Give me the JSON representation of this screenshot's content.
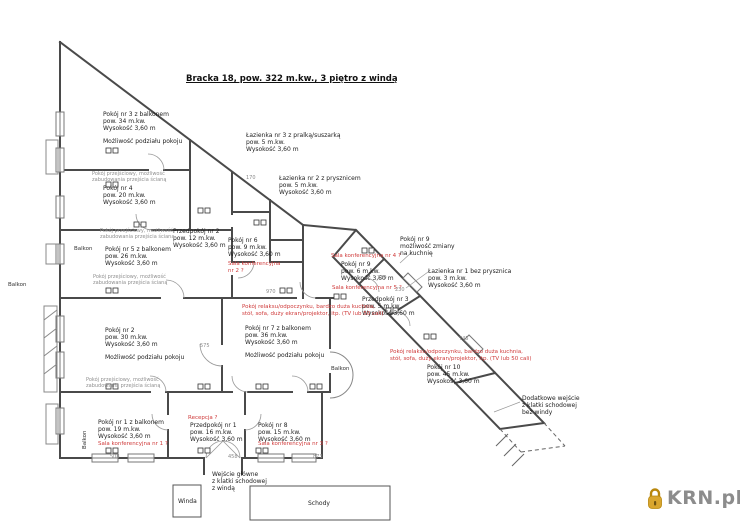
{
  "title": "Bracka 18, pow. 322 m.kw., 3 piętro z windą",
  "watermark": {
    "brand": "KRN.pl"
  },
  "colors": {
    "wall": "#4a4a4a",
    "red": "#cf3a3a",
    "note": "#8f8f8f",
    "logo_gold": "#d9a62e",
    "logo_text": "#8c8c8c"
  },
  "annotations": [
    {
      "name": "label-room-3",
      "kind": "room",
      "x": 103,
      "y": 111,
      "lines": [
        "Pokój nr 3 z balkonem",
        "pow. 34 m.kw.",
        "Wysokość 3,60 m",
        "",
        "Możliwość podziału pokoju"
      ]
    },
    {
      "name": "label-room-4",
      "kind": "room",
      "x": 103,
      "y": 185,
      "lines": [
        "Pokój nr 4",
        "pow. 20 m.kw.",
        "Wysokość 3,60 m"
      ]
    },
    {
      "name": "label-room-5",
      "kind": "room",
      "x": 105,
      "y": 246,
      "lines": [
        "Pokój nr 5 z balkonem",
        "pow. 26 m.kw.",
        "Wysokość 3,60 m"
      ]
    },
    {
      "name": "label-bath-3",
      "kind": "room",
      "x": 246,
      "y": 132,
      "lines": [
        "Łazienka nr 3 z pralką/suszarką",
        "pow. 5 m.kw.",
        "Wysokość 3,60 m"
      ]
    },
    {
      "name": "label-bath-2",
      "kind": "room",
      "x": 279,
      "y": 175,
      "lines": [
        "Łazienka nr 2 z prysznicem",
        "pow. 5 m.kw.",
        "Wysokość 3,60 m"
      ]
    },
    {
      "name": "label-hall-2",
      "kind": "room",
      "x": 173,
      "y": 228,
      "lines": [
        "Przedpokój nr 2",
        "pow. 12 m.kw.",
        "Wysokość 3,60 m"
      ]
    },
    {
      "name": "label-room-6",
      "kind": "room",
      "x": 228,
      "y": 237,
      "lines": [
        "Pokój nr 6",
        "pow. 9 m.kw.",
        "Wysokość 3,60 m"
      ]
    },
    {
      "name": "label-room-9-note",
      "kind": "room",
      "x": 400,
      "y": 236,
      "lines": [
        "Pokój nr 9",
        "możliwość zmiany",
        "na kuchnię"
      ]
    },
    {
      "name": "label-room-9",
      "kind": "room",
      "x": 341,
      "y": 261,
      "lines": [
        "Pokój nr 9",
        "pow. 6 m.kw.",
        "Wysokość 3,60 m"
      ]
    },
    {
      "name": "label-bath-1",
      "kind": "room",
      "x": 428,
      "y": 268,
      "lines": [
        "Łazienka nr 1 bez prysznica",
        "pow. 3 m.kw.",
        "Wysokość 3,60 m"
      ]
    },
    {
      "name": "label-hall-3",
      "kind": "room",
      "x": 362,
      "y": 296,
      "lines": [
        "Przedpokój nr 3",
        "pow. 5 m.kw.",
        "Wysokość 3,60 m"
      ]
    },
    {
      "name": "label-room-7",
      "kind": "room",
      "x": 245,
      "y": 325,
      "lines": [
        "Pokój nr 7 z balkonem",
        "pow. 36 m.kw.",
        "Wysokość 3,60 m",
        "",
        "Możliwość podziału pokoju"
      ]
    },
    {
      "name": "label-room-2",
      "kind": "room",
      "x": 105,
      "y": 327,
      "lines": [
        "Pokój nr 2",
        "pow. 30 m.kw.",
        "Wysokość 3,60 m",
        "",
        "Możliwość podziału pokoju"
      ]
    },
    {
      "name": "label-room-10",
      "kind": "room",
      "x": 427,
      "y": 364,
      "lines": [
        "Pokój nr 10",
        "pow. 45 m.kw.",
        "Wysokość 3,60 m"
      ]
    },
    {
      "name": "label-room-1",
      "kind": "room",
      "x": 98,
      "y": 419,
      "lines": [
        "Pokój nr 1 z balkonem",
        "pow. 19 m.kw.",
        "Wysokość 3,60 m"
      ]
    },
    {
      "name": "label-hall-1",
      "kind": "room",
      "x": 190,
      "y": 422,
      "lines": [
        "Przedpokój nr 1",
        "pow. 16 m.kw.",
        "Wysokość 3,60 m"
      ]
    },
    {
      "name": "label-room-8",
      "kind": "room",
      "x": 258,
      "y": 422,
      "lines": [
        "Pokój nr 8",
        "pow. 15 m.kw.",
        "Wysokość 3,60 m"
      ]
    },
    {
      "name": "label-entrance-main",
      "kind": "room",
      "x": 212,
      "y": 471,
      "lines": [
        "Wejście główne",
        "z klatki schodowej",
        "z windą"
      ]
    },
    {
      "name": "label-entrance-extra",
      "kind": "room",
      "x": 522,
      "y": 395,
      "lines": [
        "Dodatkowe wejście",
        "z klatki schodowej",
        "bez windy"
      ]
    },
    {
      "name": "label-winda",
      "kind": "room",
      "x": 178,
      "y": 498,
      "lines": [
        "Winda"
      ]
    },
    {
      "name": "label-schody",
      "kind": "room",
      "x": 308,
      "y": 500,
      "lines": [
        "Schody"
      ]
    },
    {
      "name": "label-balkon-left",
      "kind": "balkon",
      "x": 8,
      "y": 282,
      "lines": [
        "Balkon"
      ]
    },
    {
      "name": "label-balkon-mid",
      "kind": "balkon",
      "x": 74,
      "y": 246,
      "lines": [
        "Balkon"
      ]
    },
    {
      "name": "label-balkon-center",
      "kind": "balkon",
      "x": 331,
      "y": 366,
      "lines": [
        "Balkon"
      ]
    },
    {
      "name": "label-balkon-bottom",
      "kind": "balkon",
      "x": 82,
      "y": 449,
      "rot": -90,
      "lines": [
        "Balkon"
      ]
    },
    {
      "name": "red-sala-1",
      "kind": "red",
      "x": 98,
      "y": 441,
      "lines": [
        "Sala konferencyjna nr 1 ?"
      ]
    },
    {
      "name": "red-recepcja",
      "kind": "red",
      "x": 188,
      "y": 415,
      "lines": [
        "Recepcja ?"
      ]
    },
    {
      "name": "red-sala-3",
      "kind": "red",
      "x": 258,
      "y": 441,
      "lines": [
        "Sala konferencyjna nr 3 ?"
      ]
    },
    {
      "name": "red-sala-2",
      "kind": "red",
      "x": 228,
      "y": 261,
      "lines": [
        "Sala konferencyjna",
        "nr 2 ?"
      ]
    },
    {
      "name": "red-sala-4",
      "kind": "red",
      "x": 331,
      "y": 253,
      "lines": [
        "Sala konferencyjna nr 4 ?"
      ]
    },
    {
      "name": "red-sala-5",
      "kind": "red",
      "x": 332,
      "y": 285,
      "lines": [
        "Sala konferencyjna nr 5 ?"
      ]
    },
    {
      "name": "red-note-center",
      "kind": "red",
      "x": 242,
      "y": 304,
      "lines": [
        "Pokój relaksu/odpoczynku, bardzo duża kuchnia,",
        "stół, sofa, duży ekran/projektor, itp. (TV lub 50 cali)"
      ]
    },
    {
      "name": "red-note-right",
      "kind": "red",
      "x": 390,
      "y": 349,
      "lines": [
        "Pokój relaksu/odpoczynku, bardzo duża kuchnia,",
        "stół, sofa, duży ekran/projektor, itp. (TV lub 50 cali)"
      ]
    },
    {
      "name": "note-passage-1",
      "kind": "note",
      "x": 92,
      "y": 171,
      "lines": [
        "Pokój przejściowy, możliwość",
        "zabudowania przejścia ścianą"
      ]
    },
    {
      "name": "note-passage-2",
      "kind": "note",
      "x": 100,
      "y": 228,
      "lines": [
        "Pokój przejściowy, możliwość",
        "zabudowania przejścia ścianą"
      ]
    },
    {
      "name": "note-passage-3",
      "kind": "note",
      "x": 93,
      "y": 274,
      "lines": [
        "Pokój przejściowy, możliwość",
        "zabudowania przejścia ścianą"
      ]
    },
    {
      "name": "note-passage-4",
      "kind": "note",
      "x": 86,
      "y": 377,
      "lines": [
        "Pokój przejściowy, możliwość",
        "zabudowania przejścia ścianą"
      ]
    },
    {
      "name": "dim-970",
      "kind": "dim",
      "x": 266,
      "y": 290,
      "lines": [
        "970"
      ]
    },
    {
      "name": "dim-575",
      "kind": "dim",
      "x": 200,
      "y": 344,
      "lines": [
        "575"
      ]
    },
    {
      "name": "dim-508",
      "kind": "dim",
      "x": 110,
      "y": 455,
      "lines": [
        "508"
      ]
    },
    {
      "name": "dim-458",
      "kind": "dim",
      "x": 228,
      "y": 455,
      "lines": [
        "458"
      ]
    },
    {
      "name": "dim-873",
      "kind": "dim",
      "x": 313,
      "y": 455,
      "lines": [
        "873"
      ]
    },
    {
      "name": "dim-330",
      "kind": "dim",
      "x": 377,
      "y": 276,
      "lines": [
        "330"
      ]
    },
    {
      "name": "dim-230",
      "kind": "dim",
      "x": 395,
      "y": 288,
      "lines": [
        "230"
      ]
    },
    {
      "name": "dim-170",
      "kind": "dim",
      "x": 246,
      "y": 176,
      "lines": [
        "170"
      ]
    },
    {
      "name": "dim-745",
      "kind": "dim",
      "x": 459,
      "y": 337,
      "lines": [
        "745"
      ]
    }
  ]
}
